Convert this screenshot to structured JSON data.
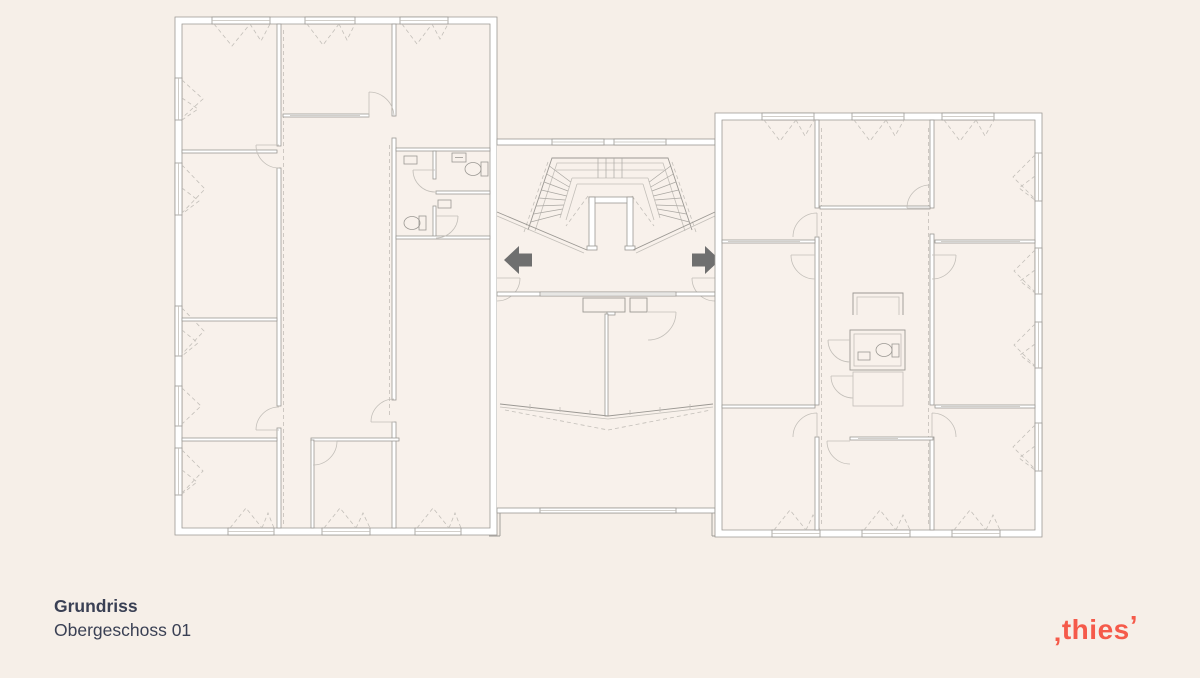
{
  "caption": {
    "title": "Grundriss",
    "subtitle": "Obergeschoss 01"
  },
  "logo": {
    "leading_mark": "‚",
    "text": "thies",
    "trailing_mark": "’"
  },
  "plan": {
    "drawing_type": "architectural-floor-plan",
    "sections": [
      "left-wing",
      "central-stairwell",
      "right-wing"
    ],
    "exit_arrows": [
      "left",
      "right"
    ]
  },
  "colors": {
    "background": "#f6efe8",
    "room_fill": "#f8f1eb",
    "plan_line": "#9b9893",
    "plan_line_light": "#c3bfb9",
    "wall_fill": "#ffffff",
    "arrow": "#6f6f6f",
    "title_text": "#3a4054",
    "logo_accent": "#f55a4a"
  }
}
